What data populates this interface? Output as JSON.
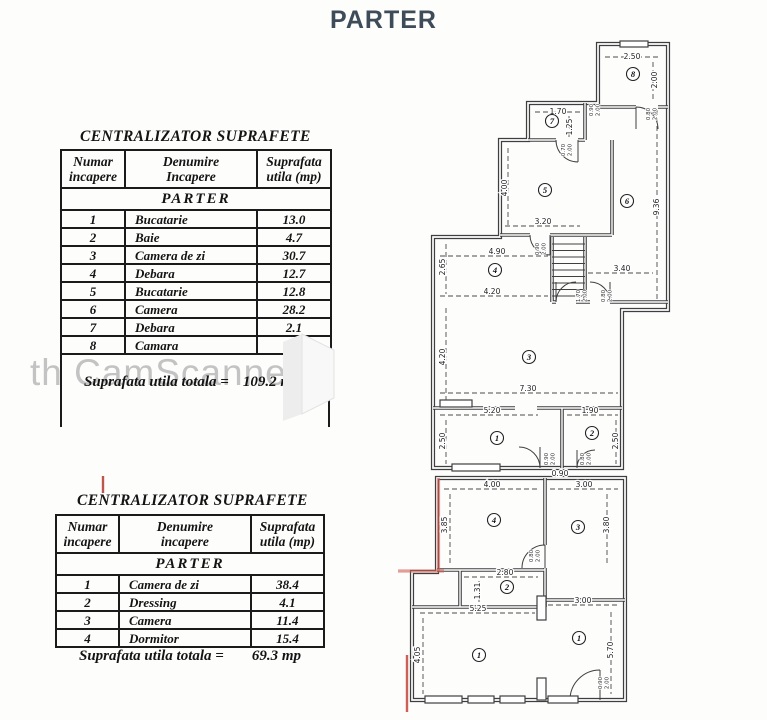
{
  "page": {
    "title": "PARTER",
    "title_color": "#3e4c59",
    "watermark": "th CamScanner",
    "accent_red": "#c24a3d"
  },
  "table1": {
    "title": "CENTRALIZATOR SUPRAFETE",
    "headers": [
      [
        "Numar",
        "incapere"
      ],
      [
        "Denumire",
        "Incapere"
      ],
      [
        "Suprafata",
        "utila (mp)"
      ]
    ],
    "section": "PARTER",
    "rows": [
      [
        "1",
        "Bucatarie",
        "13.0"
      ],
      [
        "2",
        "Baie",
        "4.7"
      ],
      [
        "3",
        "Camera de zi",
        "30.7"
      ],
      [
        "4",
        "Debara",
        "12.7"
      ],
      [
        "5",
        "Bucatarie",
        "12.8"
      ],
      [
        "6",
        "Camera",
        "28.2"
      ],
      [
        "7",
        "Debara",
        "2.1"
      ],
      [
        "8",
        "Camara",
        "5.0"
      ]
    ],
    "total_label": "Suprafata utila totala =",
    "total_value": "109.2 mp"
  },
  "table2": {
    "title": "CENTRALIZATOR SUPRAFETE",
    "headers": [
      [
        "Numar",
        "incapere"
      ],
      [
        "Denumire",
        "incapere"
      ],
      [
        "Suprafata",
        "utila (mp)"
      ]
    ],
    "section": "PARTER",
    "rows": [
      [
        "1",
        "Camera de zi",
        "38.4"
      ],
      [
        "2",
        "Dressing",
        "4.1"
      ],
      [
        "3",
        "Camera",
        "11.4"
      ],
      [
        "4",
        "Dormitor",
        "15.4"
      ]
    ],
    "total_label": "Suprafata utila totala =",
    "total_value": "69.3 mp"
  },
  "floorplan": {
    "rooms": [
      {
        "n": "8",
        "x": 633,
        "y": 74
      },
      {
        "n": "7",
        "x": 552,
        "y": 121
      },
      {
        "n": "6",
        "x": 627,
        "y": 201
      },
      {
        "n": "5",
        "x": 545,
        "y": 190
      },
      {
        "n": "4",
        "x": 495,
        "y": 270
      },
      {
        "n": "3",
        "x": 529,
        "y": 357
      },
      {
        "n": "1",
        "x": 497,
        "y": 438
      },
      {
        "n": "2",
        "x": 592,
        "y": 433
      },
      {
        "n": "4",
        "x": 494,
        "y": 520
      },
      {
        "n": "3",
        "x": 578,
        "y": 527
      },
      {
        "n": "2",
        "x": 507,
        "y": 587
      },
      {
        "n": "1",
        "x": 479,
        "y": 655
      },
      {
        "n": "1",
        "x": 579,
        "y": 638
      }
    ],
    "dimensions": [
      {
        "t": "2.50",
        "x": 632,
        "y": 59,
        "r": 0
      },
      {
        "t": "2.00",
        "x": 657,
        "y": 80,
        "r": -90
      },
      {
        "t": "1.70",
        "x": 558,
        "y": 114,
        "r": 0
      },
      {
        "t": "1.25",
        "x": 572,
        "y": 127,
        "r": -90
      },
      {
        "t": "4.00",
        "x": 507,
        "y": 188,
        "r": -90
      },
      {
        "t": "3.20",
        "x": 543,
        "y": 224,
        "r": 0
      },
      {
        "t": "9.36",
        "x": 659,
        "y": 207,
        "r": -90
      },
      {
        "t": "3.40",
        "x": 622,
        "y": 271,
        "r": 0
      },
      {
        "t": "4.90",
        "x": 497,
        "y": 254,
        "r": 0
      },
      {
        "t": "2.65",
        "x": 445,
        "y": 267,
        "r": -90
      },
      {
        "t": "4.20",
        "x": 492,
        "y": 294,
        "r": 0
      },
      {
        "t": "4.20",
        "x": 445,
        "y": 357,
        "r": -90
      },
      {
        "t": "7.30",
        "x": 528,
        "y": 391,
        "r": 0
      },
      {
        "t": "5.20",
        "x": 492,
        "y": 413,
        "r": 0
      },
      {
        "t": "2.50",
        "x": 445,
        "y": 441,
        "r": -90
      },
      {
        "t": "1.90",
        "x": 590,
        "y": 413,
        "r": 0
      },
      {
        "t": "2.50",
        "x": 618,
        "y": 441,
        "r": -90
      },
      {
        "t": "0.90",
        "x": 560,
        "y": 476,
        "r": 0
      },
      {
        "t": "4.00",
        "x": 492,
        "y": 487,
        "r": 0
      },
      {
        "t": "3.00",
        "x": 584,
        "y": 487,
        "r": 0
      },
      {
        "t": "3.85",
        "x": 447,
        "y": 525,
        "r": -90
      },
      {
        "t": "3.80",
        "x": 609,
        "y": 525,
        "r": -90
      },
      {
        "t": "2.80",
        "x": 505,
        "y": 575,
        "r": 0
      },
      {
        "t": "1.31",
        "x": 480,
        "y": 591,
        "r": -90
      },
      {
        "t": "5.25",
        "x": 478,
        "y": 611,
        "r": 0
      },
      {
        "t": "3.00",
        "x": 583,
        "y": 603,
        "r": 0
      },
      {
        "t": "4.05",
        "x": 420,
        "y": 655,
        "r": -90
      },
      {
        "t": "5.70",
        "x": 613,
        "y": 650,
        "r": -90
      }
    ],
    "door_labels": [
      {
        "a": "0.90",
        "b": "2.00",
        "x": 594,
        "y": 110
      },
      {
        "a": "0.80",
        "b": "2.00",
        "x": 651,
        "y": 114
      },
      {
        "a": "0.70",
        "b": "2.00",
        "x": 566,
        "y": 150
      },
      {
        "a": "0.90",
        "b": "2.00",
        "x": 540,
        "y": 249
      },
      {
        "a": "1.70",
        "b": "2.00",
        "x": 581,
        "y": 296
      },
      {
        "a": "0.80",
        "b": "2.00",
        "x": 606,
        "y": 296
      },
      {
        "a": "0.90",
        "b": "2.00",
        "x": 549,
        "y": 459
      },
      {
        "a": "0.80",
        "b": "2.00",
        "x": 585,
        "y": 459
      },
      {
        "a": "0.80",
        "b": "2.00",
        "x": 534,
        "y": 556
      },
      {
        "a": "0.90",
        "b": "2.00",
        "x": 603,
        "y": 683
      }
    ]
  }
}
